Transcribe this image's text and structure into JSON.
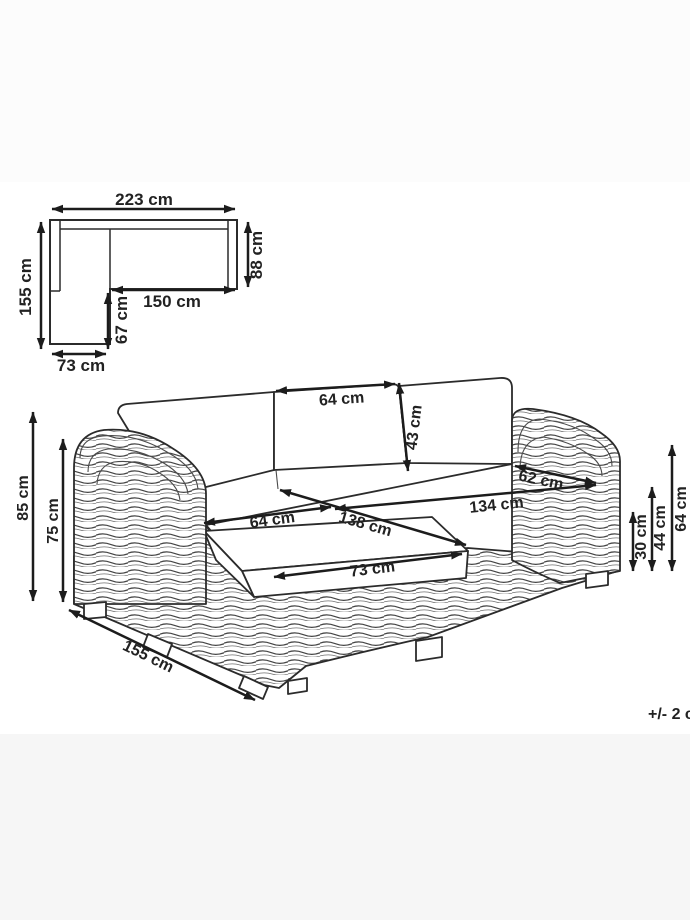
{
  "colors": {
    "background_top": "#fcfcfc",
    "background_middle": "#ffffff",
    "background_bottom": "#f6f6f6",
    "line": "#2b2b2b",
    "text": "#222222"
  },
  "tolerance_note": "+/- 2 c",
  "top_view": {
    "total_width": "223 cm",
    "total_depth": "155 cm",
    "right_side_depth": "88 cm",
    "inner_width": "150 cm",
    "chaise_inner_depth": "67 cm",
    "chaise_width": "73 cm"
  },
  "front_view": {
    "back_cushion_width": "64 cm",
    "back_cushion_height": "43 cm",
    "right_seat_depth": "62 cm",
    "seat_width_back": "134 cm",
    "seat_width_front": "138 cm",
    "left_seat_width": "64 cm",
    "ottoman_cushion_width": "73 cm",
    "overall_height": "85 cm",
    "armrest_height_left": "75 cm",
    "seat_height": "30 cm",
    "cushion_height": "44 cm",
    "armrest_height_right": "64 cm",
    "chaise_length": "155 cm"
  }
}
